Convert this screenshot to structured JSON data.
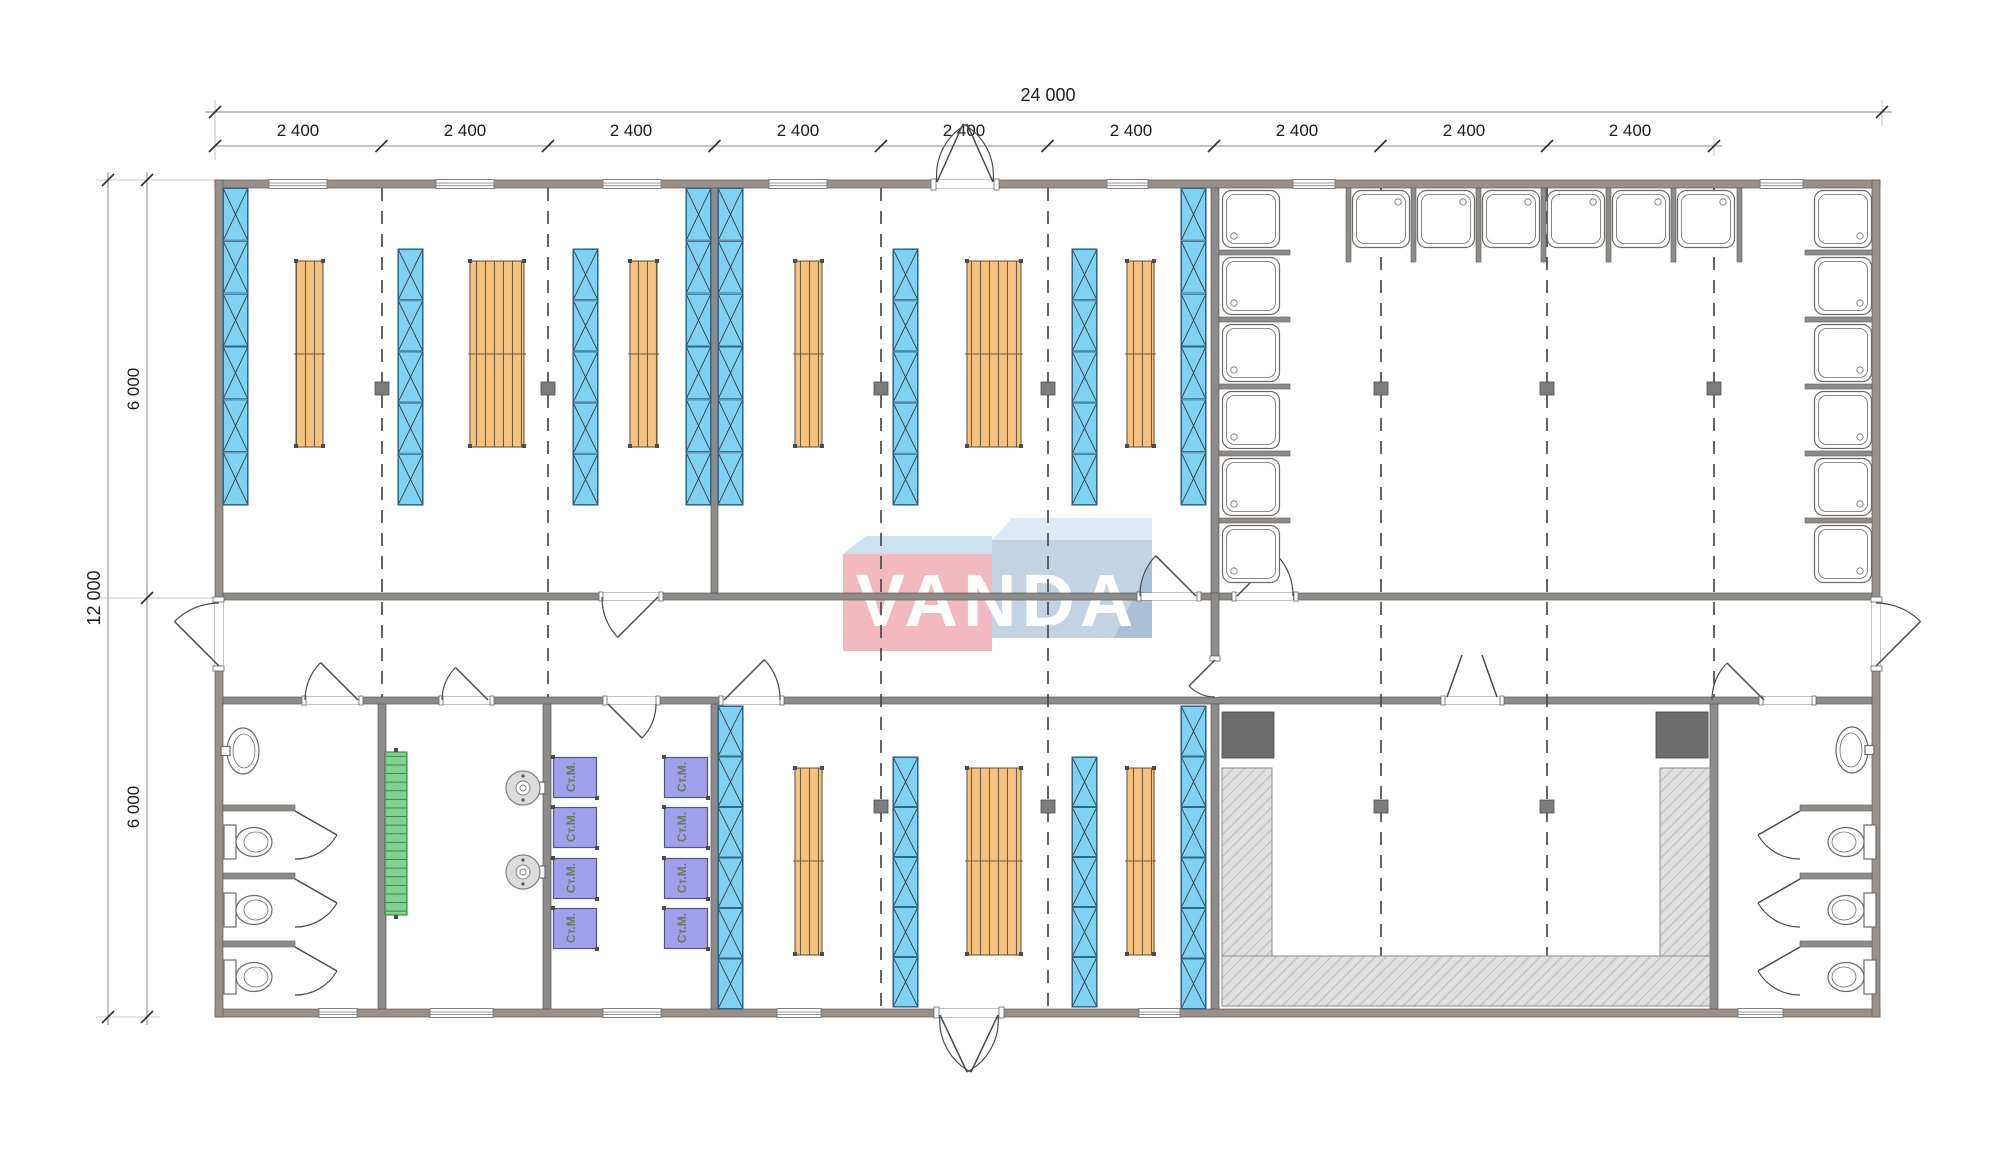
{
  "dims": {
    "total_width": "24 000",
    "module": "2 400",
    "total_height": "12 000",
    "half_height": "6 000"
  },
  "logo": {
    "text": "VANDA"
  },
  "labels": {
    "washing_machine": "Ст.М."
  },
  "plan_summary": {
    "modules_wide": 10,
    "modules_labeled": 9,
    "bunk_bed_panels": 12,
    "locker_units": 9,
    "shower_trays": 18,
    "toilets": 6,
    "sinks": 2,
    "washing_machines": 8,
    "water_heaters": 2,
    "benches": 1,
    "drying_benches": 3,
    "heater_units": 2
  },
  "colors": {
    "wall": "#8e8c8a",
    "wall-ext": "#99908a",
    "wall-line": "#5a5a5a",
    "bed-blue": "#7ed3f4",
    "bed-blue-line": "#2d6a8c",
    "locker-orange": "#f6c27f",
    "locker-line": "#6b5a3f",
    "bench-green": "#7fd38d",
    "bench-green-line": "#3f7d4b",
    "machine-purple": "#a2a0ed",
    "machine-line": "#55557e",
    "machine-text": "#6f7a55",
    "hatch-fill": "#e0e0e0",
    "hatch-line": "#bcbcbc",
    "dark-unit": "#6d6d6d",
    "fixture-line": "#6a6a6a",
    "dash-line": "#4a4a4a",
    "dim-line": "#8a8a8a",
    "dim-text": "#1c1c1c",
    "logo-pink": "#f3b9c0",
    "logo-pink-top": "#cde2f1",
    "logo-blue": "#c2d3e3",
    "logo-blue-top": "#ddebf7",
    "logo-blue-side": "#a9c0d6",
    "logo-text": "#ffffff"
  }
}
